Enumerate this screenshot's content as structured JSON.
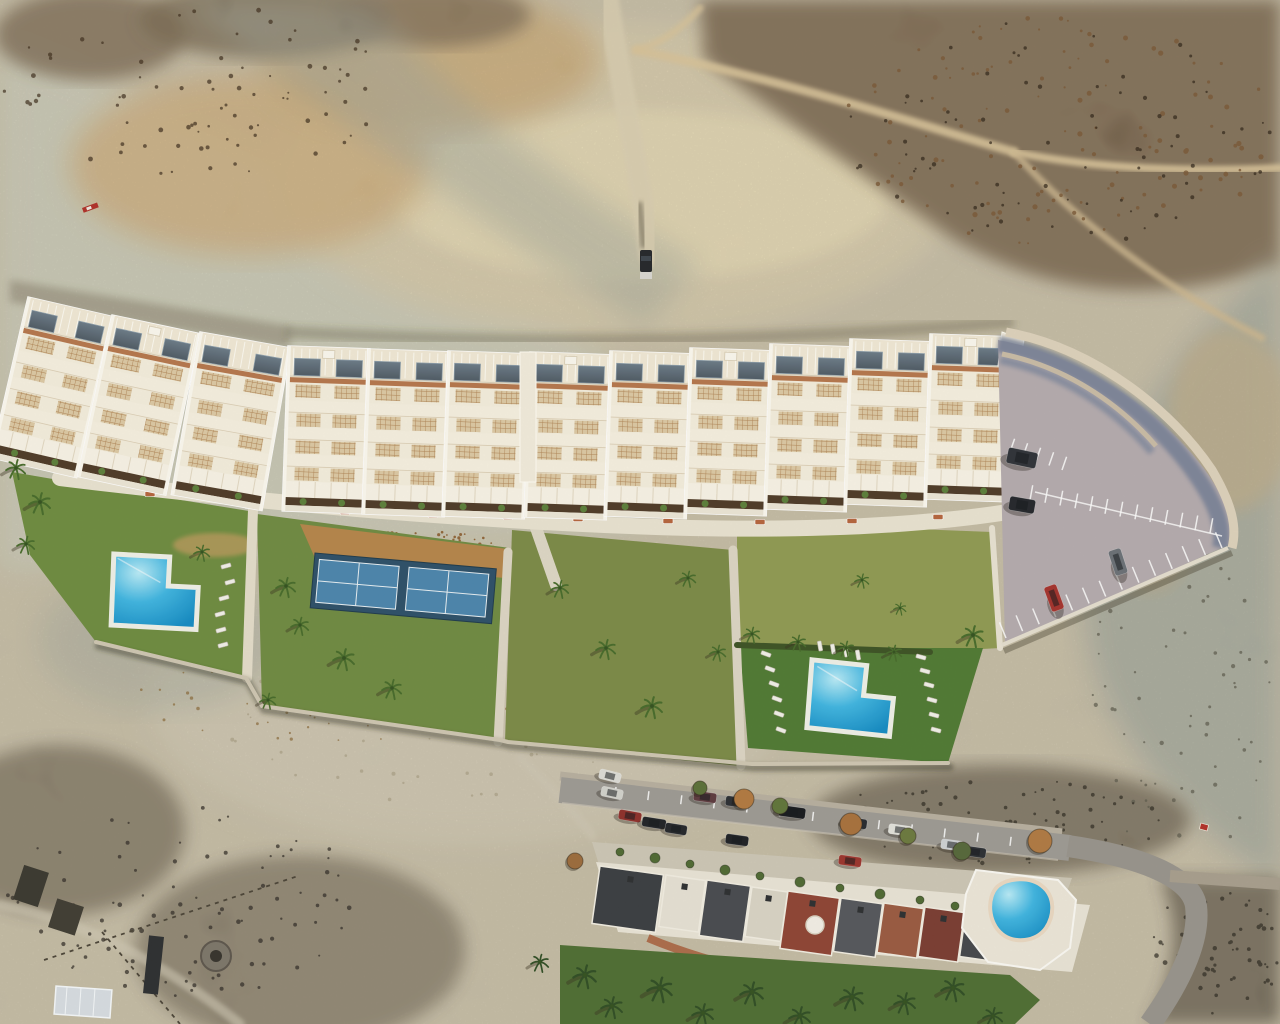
{
  "scene": {
    "title": "aerial-drone-photo-new-residential-development",
    "kind": "photomontage-render",
    "features": [
      "desert-badlands-terrain",
      "terraced-apartment-row",
      "communal-gardens",
      "two-l-shaped-pools",
      "padel-court",
      "parking-lot",
      "existing-street-with-houses",
      "kidney-pool",
      "scrubland"
    ]
  },
  "colors": {
    "desert_base": "#c8c1ab",
    "pale_wash": "#ccd2c3",
    "cream_canyon": "#ddd1b0",
    "sunlit_cream": "#f0e4bb",
    "warm_tan": "#d0a96e",
    "dark_scrub": "#55412b",
    "scrub_rust": "#7a5836",
    "shadow_teal": "#8d9c9a",
    "right_slope": "#97a29b",
    "bowl_pale": "#d3cdba",
    "lawn_a": "#6d8c3f",
    "lawn_b": "#6f8a41",
    "lawn_c": "#7b8a47",
    "meadow": "#8f9a52",
    "lawn_e": "#4f7a33",
    "mulch": "#b5854a",
    "court_surround": "#2c4f68",
    "court_field": "#4a85ad",
    "court_line": "#e8f0f4",
    "pool_light": "#b9ecf8",
    "pool_mid": "#3fb6e2",
    "pool_deep": "#128bc4",
    "deck_white": "#f0f1e8",
    "walk": "#e8e2d0",
    "building_white": "#f4eedd",
    "roof_white": "#f1e9d5",
    "glass": "#5b6b77",
    "trim_terracotta": "#b5764c",
    "lattice_bg": "#dcc9a4",
    "lattice_line": "#b08455",
    "planter": "#4e3a27",
    "bush": "#5b7f3a",
    "parking_asphalt": "#b4abae",
    "wall_cream": "#d8cbb4",
    "wall_shadow": "#6f7c94",
    "street_asphalt": "#9d9a94",
    "old_house_white": "#e9e4d6",
    "lawn_bottom": "#4e6e33",
    "palm_green": "#466b2a",
    "palm_dark": "#2f4d24"
  },
  "buildings": {
    "blocks": [
      {
        "x": 28,
        "y": 297,
        "w": 88,
        "rot": 13,
        "box": false
      },
      {
        "x": 112,
        "y": 315,
        "w": 90,
        "rot": 12,
        "box": true
      },
      {
        "x": 200,
        "y": 332,
        "w": 92,
        "rot": 10,
        "box": false
      },
      {
        "x": 288,
        "y": 346,
        "w": 82,
        "rot": 2,
        "box": true
      },
      {
        "x": 368,
        "y": 349,
        "w": 82,
        "rot": 2,
        "box": false
      },
      {
        "x": 448,
        "y": 351,
        "w": 82,
        "rot": 2,
        "box": false
      },
      {
        "x": 530,
        "y": 352,
        "w": 82,
        "rot": 2,
        "box": true
      },
      {
        "x": 610,
        "y": 351,
        "w": 82,
        "rot": 2,
        "box": false
      },
      {
        "x": 690,
        "y": 348,
        "w": 82,
        "rot": 2,
        "box": true
      },
      {
        "x": 770,
        "y": 344,
        "w": 82,
        "rot": 2,
        "box": false
      },
      {
        "x": 850,
        "y": 339,
        "w": 82,
        "rot": 2,
        "box": false
      },
      {
        "x": 930,
        "y": 334,
        "w": 82,
        "rot": 2,
        "box": true
      }
    ],
    "height": 165
  },
  "vegetation": {
    "palms": [
      [
        16,
        468,
        1.1
      ],
      [
        40,
        502,
        1.2
      ],
      [
        26,
        544,
        1.0
      ],
      [
        202,
        552,
        0.9
      ],
      [
        286,
        586,
        1.1
      ],
      [
        300,
        625,
        1.0
      ],
      [
        344,
        658,
        1.2
      ],
      [
        392,
        688,
        1.1
      ],
      [
        268,
        700,
        0.9
      ],
      [
        560,
        588,
        1.0
      ],
      [
        606,
        648,
        1.1
      ],
      [
        652,
        706,
        1.2
      ],
      [
        688,
        578,
        0.9
      ],
      [
        718,
        652,
        0.9
      ],
      [
        752,
        634,
        0.9
      ],
      [
        798,
        642,
        0.9
      ],
      [
        846,
        648,
        0.9
      ],
      [
        894,
        652,
        0.9
      ],
      [
        973,
        635,
        1.2
      ],
      [
        862,
        580,
        0.8
      ],
      [
        900,
        608,
        0.7
      ]
    ],
    "palms_dark": [
      [
        585,
        975,
        1.3
      ],
      [
        612,
        1006,
        1.2
      ],
      [
        660,
        988,
        1.4
      ],
      [
        703,
        1013,
        1.2
      ],
      [
        752,
        992,
        1.3
      ],
      [
        800,
        1016,
        1.2
      ],
      [
        852,
        997,
        1.3
      ],
      [
        905,
        1002,
        1.2
      ],
      [
        953,
        988,
        1.3
      ],
      [
        993,
        1016,
        1.1
      ],
      [
        540,
        962,
        1.0
      ]
    ],
    "street_trees": [
      [
        744,
        799,
        10,
        "#b27a40"
      ],
      [
        851,
        824,
        11,
        "#a8713c"
      ],
      [
        1040,
        841,
        12,
        "#b07a42"
      ],
      [
        575,
        861,
        8,
        "#9c6c3c"
      ],
      [
        908,
        836,
        8,
        "#6b7a3e"
      ],
      [
        700,
        788,
        7,
        "#5a7038"
      ],
      [
        780,
        806,
        8,
        "#60753a"
      ],
      [
        962,
        851,
        9,
        "#55683a"
      ]
    ],
    "patio_trees": [
      [
        620,
        852,
        4
      ],
      [
        655,
        858,
        5
      ],
      [
        690,
        864,
        4
      ],
      [
        725,
        870,
        5
      ],
      [
        760,
        876,
        4
      ],
      [
        800,
        882,
        5
      ],
      [
        840,
        888,
        4
      ],
      [
        880,
        894,
        5
      ],
      [
        920,
        900,
        4
      ],
      [
        955,
        906,
        4
      ]
    ]
  },
  "furniture": {
    "benches": [
      [
        150,
        494
      ],
      [
        250,
        506
      ],
      [
        345,
        512
      ],
      [
        433,
        515
      ],
      [
        508,
        517
      ],
      [
        578,
        519
      ],
      [
        668,
        521
      ],
      [
        760,
        522
      ],
      [
        852,
        521
      ],
      [
        938,
        517
      ]
    ],
    "loungers_left_pool": [
      [
        226,
        566,
        -15
      ],
      [
        230,
        582,
        -15
      ],
      [
        224,
        598,
        -15
      ],
      [
        220,
        614,
        -15
      ],
      [
        221,
        630,
        -15
      ],
      [
        223,
        645,
        -15
      ]
    ],
    "loungers_right_pool": [
      [
        766,
        654,
        20
      ],
      [
        770,
        669,
        20
      ],
      [
        774,
        684,
        20
      ],
      [
        777,
        699,
        20
      ],
      [
        779,
        714,
        20
      ],
      [
        781,
        730,
        20
      ],
      [
        921,
        657,
        15
      ],
      [
        925,
        671,
        15
      ],
      [
        929,
        685,
        15
      ],
      [
        932,
        700,
        15
      ],
      [
        934,
        715,
        15
      ],
      [
        936,
        730,
        15
      ],
      [
        820,
        646,
        80
      ],
      [
        833,
        649,
        80
      ],
      [
        846,
        652,
        80
      ],
      [
        858,
        655,
        80
      ]
    ],
    "loungers_old_pool": [
      [
        1056,
        906,
        -35
      ],
      [
        1062,
        918,
        -35
      ],
      [
        1068,
        930,
        -35
      ]
    ]
  },
  "parking": {
    "cars": [
      {
        "x": 1022,
        "y": 458,
        "w": 30,
        "h": 16,
        "rot": 12,
        "color": "#2e3238"
      },
      {
        "x": 1022,
        "y": 505,
        "w": 26,
        "h": 14,
        "rot": 10,
        "color": "#23262b"
      },
      {
        "x": 1118,
        "y": 562,
        "w": 13,
        "h": 26,
        "rot": -18,
        "color": "#6a7076"
      },
      {
        "x": 1054,
        "y": 598,
        "w": 13,
        "h": 26,
        "rot": -20,
        "color": "#a4322c"
      }
    ],
    "line_rows": [
      {
        "x1": 1006,
        "y1": 638,
        "x2": 1222,
        "y2": 548,
        "n": 13,
        "len": 17,
        "dir": -1
      },
      {
        "x1": 1030,
        "y1": 500,
        "x2": 1210,
        "y2": 533,
        "n": 12,
        "len": 15,
        "dir": -1
      },
      {
        "x1": 1010,
        "y1": 452,
        "x2": 1062,
        "y2": 470,
        "n": 4,
        "len": 14,
        "dir": -1
      }
    ]
  },
  "street": {
    "cars": [
      {
        "x": 610,
        "y": 776,
        "w": 22,
        "h": 10,
        "rot": 14,
        "color": "#dcdcd6"
      },
      {
        "x": 612,
        "y": 793,
        "w": 22,
        "h": 10,
        "rot": 12,
        "color": "#d2d2cc"
      },
      {
        "x": 630,
        "y": 816,
        "w": 23,
        "h": 10,
        "rot": 10,
        "color": "#8e2f2a"
      },
      {
        "x": 654,
        "y": 823,
        "w": 24,
        "h": 10,
        "rot": 9,
        "color": "#1f2226"
      },
      {
        "x": 676,
        "y": 829,
        "w": 22,
        "h": 10,
        "rot": 9,
        "color": "#23262a"
      },
      {
        "x": 705,
        "y": 797,
        "w": 23,
        "h": 10,
        "rot": 8,
        "color": "#5c3a3e"
      },
      {
        "x": 737,
        "y": 802,
        "w": 23,
        "h": 10,
        "rot": 8,
        "color": "#2a2d32"
      },
      {
        "x": 792,
        "y": 812,
        "w": 27,
        "h": 11,
        "rot": 8,
        "color": "#17191d"
      },
      {
        "x": 855,
        "y": 823,
        "w": 24,
        "h": 10,
        "rot": 8,
        "color": "#26292e"
      },
      {
        "x": 850,
        "y": 861,
        "w": 23,
        "h": 10,
        "rot": 8,
        "color": "#9b342c"
      },
      {
        "x": 737,
        "y": 840,
        "w": 23,
        "h": 10,
        "rot": 8,
        "color": "#1d2024"
      },
      {
        "x": 900,
        "y": 830,
        "w": 23,
        "h": 10,
        "rot": 8,
        "color": "#e2e2dc"
      },
      {
        "x": 952,
        "y": 845,
        "w": 22,
        "h": 10,
        "rot": 8,
        "color": "#cfd2d4"
      },
      {
        "x": 975,
        "y": 852,
        "w": 22,
        "h": 10,
        "rot": 8,
        "color": "#2b2e33"
      }
    ],
    "tick_row": {
      "x1": 616,
      "y1": 787,
      "x2": 1044,
      "y2": 841,
      "n": 13,
      "len": 9,
      "dir": 1
    }
  },
  "houses": {
    "roofs": [
      {
        "x": 600,
        "y": 866,
        "w": 64,
        "h": 58,
        "color": "#3a3d41"
      },
      {
        "x": 666,
        "y": 875,
        "w": 40,
        "h": 52,
        "color": "#e6e1d4"
      },
      {
        "x": 707,
        "y": 880,
        "w": 44,
        "h": 56,
        "color": "#474a4f"
      },
      {
        "x": 752,
        "y": 887,
        "w": 36,
        "h": 50,
        "color": "#d9d4c6"
      },
      {
        "x": 788,
        "y": 891,
        "w": 52,
        "h": 58,
        "color": "#8e4434"
      },
      {
        "x": 841,
        "y": 898,
        "w": 42,
        "h": 54,
        "color": "#54575c"
      },
      {
        "x": 884,
        "y": 903,
        "w": 40,
        "h": 50,
        "color": "#9a5a40"
      },
      {
        "x": 925,
        "y": 907,
        "w": 40,
        "h": 50,
        "color": "#7a3c31"
      },
      {
        "x": 966,
        "y": 911,
        "w": 36,
        "h": 46,
        "color": "#44474b"
      },
      {
        "x": 1003,
        "y": 914,
        "w": 34,
        "h": 42,
        "color": "#c9c4b6"
      }
    ],
    "rot": 8
  },
  "scatters": [
    {
      "cx": 1060,
      "cy": 130,
      "rx": 220,
      "ry": 115,
      "n": 130,
      "rmin": 1,
      "rmax": 2.6,
      "color": "#7a5836",
      "op": 0.8,
      "seed": 11
    },
    {
      "cx": 1060,
      "cy": 130,
      "rx": 220,
      "ry": 115,
      "n": 80,
      "rmin": 1,
      "rmax": 2.2,
      "color": "#2f2418",
      "op": 0.7,
      "seed": 12
    },
    {
      "cx": 200,
      "cy": 90,
      "rx": 200,
      "ry": 85,
      "n": 80,
      "rmin": 1,
      "rmax": 2.4,
      "color": "#3f2f1e",
      "op": 0.7,
      "seed": 13
    },
    {
      "cx": 405,
      "cy": 548,
      "rx": 100,
      "ry": 20,
      "n": 90,
      "rmin": 0.8,
      "rmax": 1.8,
      "color": "#8a5c2e",
      "op": 0.9,
      "seed": 14
    },
    {
      "cx": 865,
      "cy": 590,
      "rx": 112,
      "ry": 52,
      "n": 55,
      "rmin": 1,
      "rmax": 2,
      "color": "#e8e4d0",
      "op": 0.9,
      "seed": 15
    },
    {
      "cx": 865,
      "cy": 600,
      "rx": 112,
      "ry": 48,
      "n": 40,
      "rmin": 1,
      "rmax": 2,
      "color": "#5d6e35",
      "op": 0.8,
      "seed": 16
    },
    {
      "cx": 470,
      "cy": 690,
      "rx": 270,
      "ry": 115,
      "n": 110,
      "rmin": 0.8,
      "rmax": 2,
      "color": "#a99f86",
      "op": 0.7,
      "seed": 17
    },
    {
      "cx": 330,
      "cy": 700,
      "rx": 200,
      "ry": 42,
      "n": 70,
      "rmin": 0.8,
      "rmax": 1.8,
      "color": "#8a6a3a",
      "op": 0.7,
      "seed": 18
    },
    {
      "cx": 180,
      "cy": 900,
      "rx": 175,
      "ry": 100,
      "n": 95,
      "rmin": 1,
      "rmax": 2.4,
      "color": "#35302a",
      "op": 0.75,
      "seed": 19
    },
    {
      "cx": 1180,
      "cy": 700,
      "rx": 90,
      "ry": 175,
      "n": 70,
      "rmin": 1,
      "rmax": 2.2,
      "color": "#5c5a4c",
      "op": 0.7,
      "seed": 20
    },
    {
      "cx": 620,
      "cy": 650,
      "rx": 90,
      "ry": 85,
      "n": 45,
      "rmin": 0.8,
      "rmax": 1.6,
      "color": "#5d6e35",
      "op": 0.6,
      "seed": 21
    },
    {
      "cx": 1000,
      "cy": 820,
      "rx": 170,
      "ry": 45,
      "n": 80,
      "rmin": 1,
      "rmax": 2.2,
      "color": "#2e2a22",
      "op": 0.7,
      "seed": 22
    },
    {
      "cx": 1215,
      "cy": 950,
      "rx": 65,
      "ry": 75,
      "n": 60,
      "rmin": 1,
      "rmax": 2.4,
      "color": "#2e2a22",
      "op": 0.7,
      "seed": 23
    }
  ],
  "boulders": [
    [
      940,
      838,
      5
    ],
    [
      950,
      830,
      4
    ],
    [
      962,
      842,
      6
    ],
    [
      975,
      834,
      4
    ],
    [
      983,
      846,
      5
    ],
    [
      955,
      852,
      3
    ]
  ]
}
